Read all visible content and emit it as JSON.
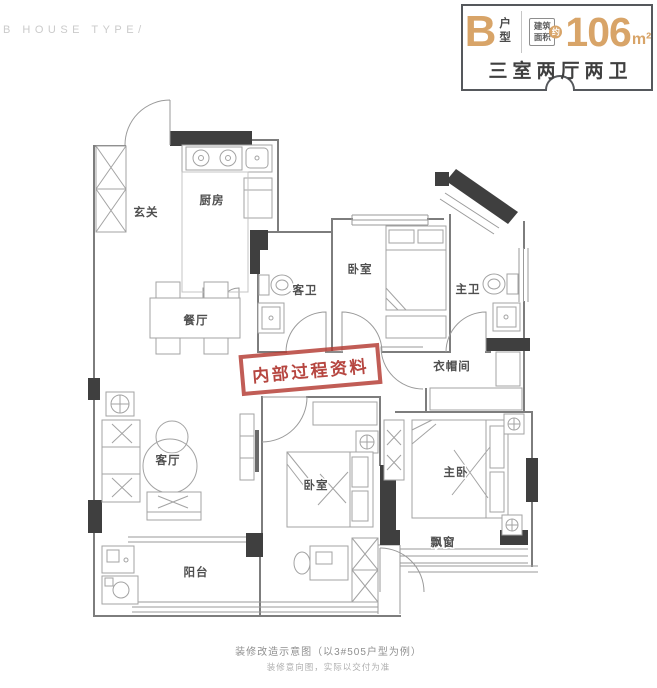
{
  "brand": "B HOUSE TYPE/",
  "header": {
    "house_type": "B",
    "house_type_suffix": "户型",
    "area_label": "建筑面积",
    "area_approx": "约",
    "area_value": "106",
    "area_unit": "m²",
    "summary": "三室两厅两卫",
    "accent_color": "#D8A468",
    "dark_color": "#3F3F3F"
  },
  "rooms": [
    {
      "id": "entry",
      "label": "玄关"
    },
    {
      "id": "kitchen",
      "label": "厨房"
    },
    {
      "id": "dining",
      "label": "餐厅"
    },
    {
      "id": "guest-bath",
      "label": "客卫"
    },
    {
      "id": "bedroom-2",
      "label": "卧室"
    },
    {
      "id": "master-bath",
      "label": "主卫"
    },
    {
      "id": "cloakroom",
      "label": "衣帽间"
    },
    {
      "id": "living",
      "label": "客厅"
    },
    {
      "id": "bedroom-3",
      "label": "卧室"
    },
    {
      "id": "master-bedroom",
      "label": "主卧"
    },
    {
      "id": "bay-window",
      "label": "飘窗"
    },
    {
      "id": "balcony",
      "label": "阳台"
    }
  ],
  "stamp": {
    "text": "内部过程资料",
    "color": "#B2342C"
  },
  "footer": {
    "line1": "装修改造示意图（以3#505户型为例）",
    "line2": "装修意向图，实际以交付为准"
  }
}
